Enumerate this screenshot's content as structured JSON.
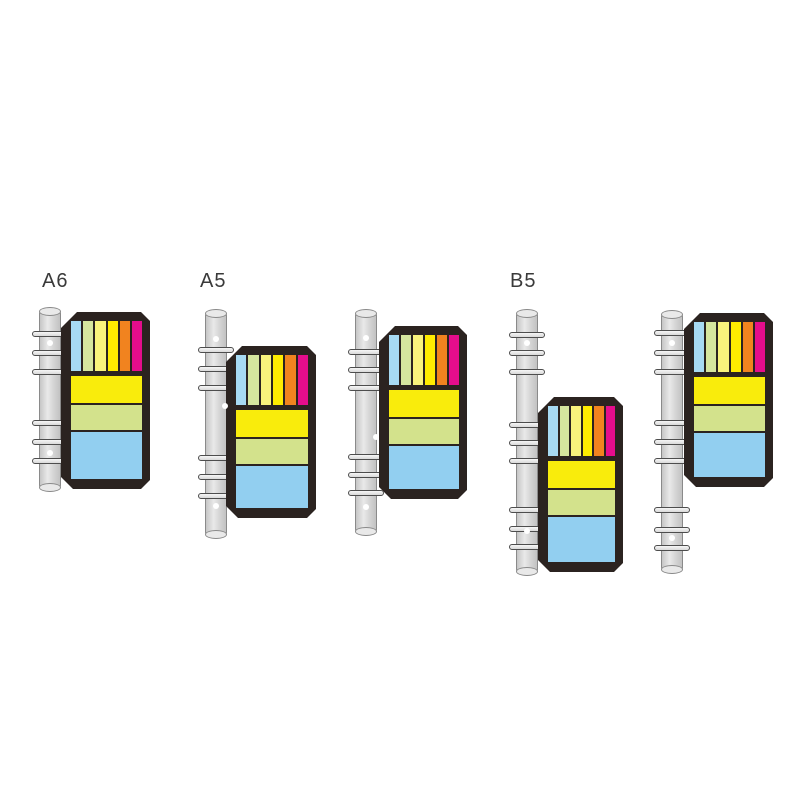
{
  "page": {
    "background": "#ffffff",
    "description_labels": [
      "A6",
      "A5",
      "B5"
    ]
  },
  "colors": {
    "label_text": "#3a3a3a",
    "panel": "#2b2320",
    "spine_edge": "#8a8a8a",
    "ring_edge": "#4d4d4d",
    "hole": "#ffffff",
    "tab_colors": [
      "#A7DAF3",
      "#D6E69E",
      "#F9F37C",
      "#FFEC00",
      "#F1831F",
      "#E50D8C"
    ],
    "pad_colors": [
      "#F9EC0C",
      "#D3E28C",
      "#92CFF0"
    ]
  },
  "panel_design": {
    "inset": {
      "top": 9,
      "right": 8,
      "bottom": 10,
      "left": 10
    },
    "strip_height": 50,
    "strip_gap_below": 5,
    "pad_gap": 2,
    "pad_heights": [
      27,
      25,
      "fill"
    ],
    "pad_names": [
      "sticky-pad-yellow",
      "sticky-pad-green",
      "sticky-pad-blue"
    ],
    "tab_names": [
      "index-tab-blue",
      "index-tab-green",
      "index-tab-pale-yellow",
      "index-tab-yellow",
      "index-tab-orange",
      "index-tab-magenta"
    ],
    "chamfer": {
      "top_left": 16,
      "bottom_left": 12,
      "right_radius": 9
    }
  },
  "groups": [
    {
      "name": "a6-binder",
      "label": "A6",
      "label_pos": {
        "x": 42,
        "y": 271
      },
      "spine": {
        "x": 39,
        "y": 308,
        "w": 22,
        "h": 183
      },
      "rings_y": [
        334,
        353,
        372,
        423,
        442,
        461
      ],
      "holes": [
        {
          "x": 50,
          "y": 343
        },
        {
          "x": 50,
          "y": 453
        }
      ],
      "panel": {
        "x": 61,
        "y": 312,
        "w": 89,
        "h": 177
      }
    },
    {
      "name": "a5-binder-front",
      "label": "A5",
      "label_pos": {
        "x": 200,
        "y": 271
      },
      "spine": {
        "x": 205,
        "y": 310,
        "w": 22,
        "h": 228
      },
      "rings_y": [
        350,
        369,
        388,
        458,
        477,
        496
      ],
      "holes": [
        {
          "x": 216,
          "y": 339
        },
        {
          "x": 216,
          "y": 506
        },
        {
          "x": 225,
          "y": 406
        }
      ],
      "panel": {
        "x": 226,
        "y": 346,
        "w": 90,
        "h": 172
      }
    },
    {
      "name": "a5-binder-back",
      "label": null,
      "label_pos": null,
      "spine": {
        "x": 355,
        "y": 310,
        "w": 22,
        "h": 225
      },
      "rings_y": [
        352,
        370,
        388,
        457,
        475,
        493
      ],
      "holes": [
        {
          "x": 366,
          "y": 338
        },
        {
          "x": 366,
          "y": 507
        },
        {
          "x": 376,
          "y": 437
        }
      ],
      "panel": {
        "x": 379,
        "y": 326,
        "w": 88,
        "h": 173
      }
    },
    {
      "name": "b5-binder-front",
      "label": "B5",
      "label_pos": {
        "x": 510,
        "y": 271
      },
      "spine": {
        "x": 516,
        "y": 310,
        "w": 22,
        "h": 265
      },
      "rings_y": [
        335,
        353,
        372,
        425,
        443,
        461,
        510,
        529,
        547
      ],
      "holes": [
        {
          "x": 527,
          "y": 343
        },
        {
          "x": 527,
          "y": 531
        }
      ],
      "panel": {
        "x": 538,
        "y": 397,
        "w": 85,
        "h": 175
      }
    },
    {
      "name": "b5-binder-back",
      "label": null,
      "label_pos": null,
      "spine": {
        "x": 661,
        "y": 311,
        "w": 22,
        "h": 262
      },
      "rings_y": [
        333,
        353,
        372,
        423,
        442,
        461,
        510,
        530,
        548
      ],
      "holes": [
        {
          "x": 672,
          "y": 343
        },
        {
          "x": 672,
          "y": 538
        }
      ],
      "panel": {
        "x": 684,
        "y": 313,
        "w": 89,
        "h": 174
      }
    }
  ]
}
